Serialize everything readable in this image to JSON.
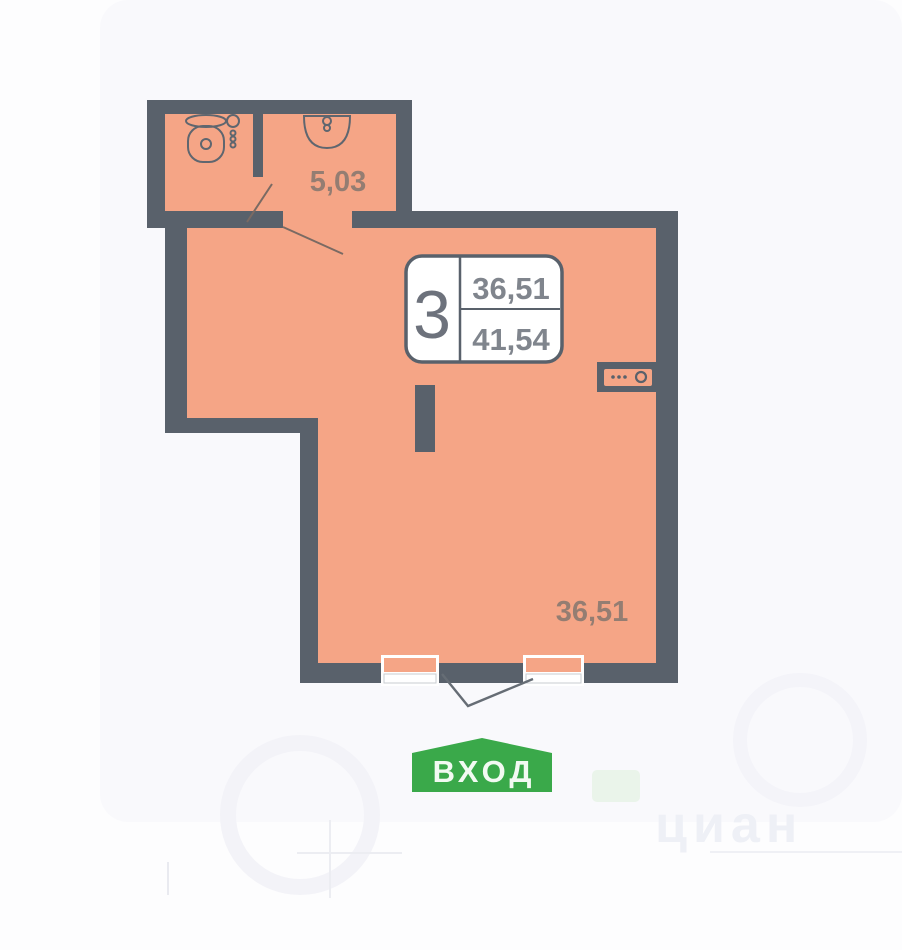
{
  "plan": {
    "title": "apartment-floor-plan",
    "unit_badge": {
      "rooms": "3",
      "area_top": "36,51",
      "area_bottom": "41,54"
    },
    "room_labels": {
      "bathroom_area": "5,03",
      "main_area": "36,51"
    },
    "entrance_label": "ВХОД",
    "watermark": "циан",
    "icons": {
      "toilet": "toilet-icon",
      "sink": "sink-icon",
      "towel_radiator": "towel-radiator-icon",
      "electric_panel": "electric-panel-icon"
    },
    "colors": {
      "wall": "#59616b",
      "floor": "#f5a586",
      "entrance_green": "#3aa94a",
      "label": "#8c7a71",
      "badge_border": "#59616b",
      "badge_number": "#80858d",
      "watermark": "#eef0f6"
    }
  }
}
